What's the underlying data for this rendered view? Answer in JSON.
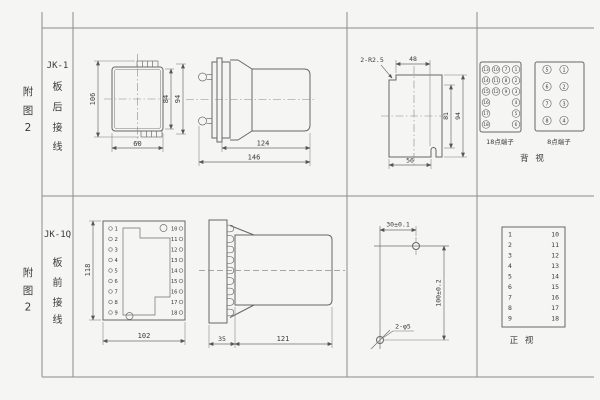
{
  "palette": {
    "bg": "#f5f5f3",
    "line": "#666666",
    "grid": "#8c8c8c",
    "text": "#3b3b3b"
  },
  "row1": {
    "figure": [
      "附",
      "图",
      "2"
    ],
    "model": "JK-1",
    "wiring": [
      "板",
      "后",
      "接",
      "线"
    ],
    "front": {
      "total_height": "106",
      "body_height": "84",
      "outer_height": "94",
      "width": "60"
    },
    "side": {
      "body_length": "124",
      "total_length": "146"
    },
    "cutout": {
      "corner_note": "2-R2.5",
      "top_width": "48",
      "inner_height": "81",
      "outer_height": "94",
      "bottom_width": "56"
    },
    "terminal18": [
      "13",
      "10",
      "7",
      "1",
      "14",
      "11",
      "8",
      "2",
      "15",
      "12",
      "9",
      "3",
      "16",
      "4",
      "17",
      "5",
      "18",
      "6"
    ],
    "terminal8": [
      "5",
      "1",
      "6",
      "2",
      "7",
      "3",
      "8",
      "4"
    ],
    "label18": "18点端子",
    "label8": "8点端子",
    "view_label": "背 视"
  },
  "row2": {
    "figure": [
      "附",
      "图",
      "2"
    ],
    "model": "JK-1Q",
    "wiring": [
      "板",
      "前",
      "接",
      "线"
    ],
    "plug": {
      "left": [
        "1",
        "2",
        "3",
        "4",
        "5",
        "6",
        "7",
        "8",
        "9"
      ],
      "right": [
        "10",
        "11",
        "12",
        "13",
        "14",
        "15",
        "16",
        "17",
        "18"
      ]
    },
    "front": {
      "height": "118",
      "width": "102"
    },
    "side": {
      "plate_depth": "35",
      "body_length": "121"
    },
    "drill": {
      "h_dim": "30±0.1",
      "v_dim": "100±0.2",
      "hole_note": "2-φ5"
    },
    "view_label": "正 视"
  }
}
